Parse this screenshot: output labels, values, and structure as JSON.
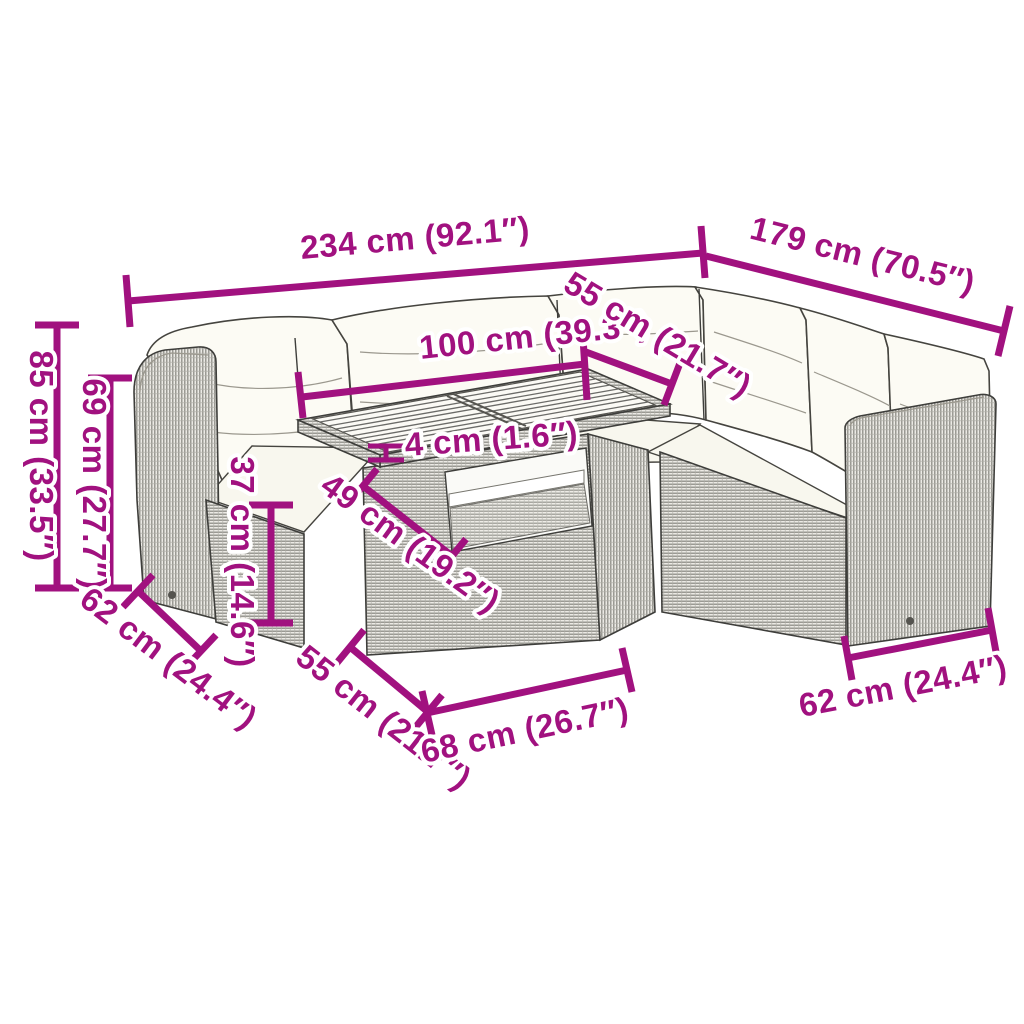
{
  "diagram": {
    "accent_color": "#A1117F",
    "outline_color": "#3E3E3B",
    "rattan_color": "#ECEAE5",
    "cushion_color": "#FCFBF4",
    "background_color": "#FFFFFF",
    "dims": {
      "overall_width": "234 cm (92.1″)",
      "overall_depth": "179 cm (70.5″)",
      "table_width": "100 cm (39.3″)",
      "table_depth_top": "55 cm (21.7″)",
      "top_thickness": "4 cm (1.6″)",
      "table_height": "49 cm (19.2″)",
      "back_height": "85 cm (33.5″)",
      "armrest_height": "69 cm (27.7″)",
      "seat_height": "37 cm (14.6″)",
      "seat_depth_left": "62 cm (24.4″)",
      "table_depth_bottom": "55 cm (21.7″)",
      "table_front_width": "68 cm (26.7″)",
      "seat_depth_right": "62 cm (24.4″)"
    }
  }
}
